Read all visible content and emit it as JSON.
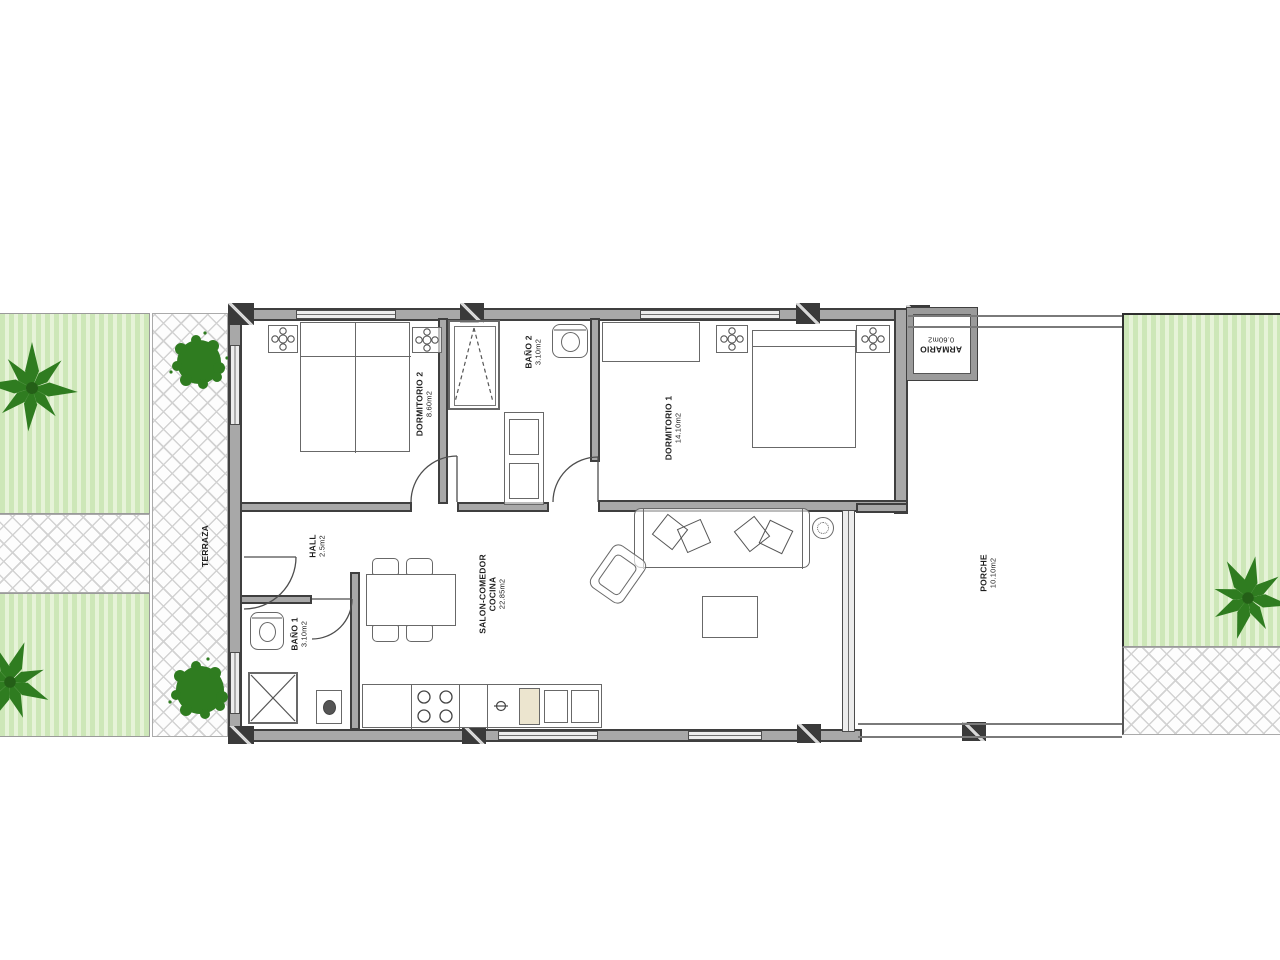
{
  "plan": {
    "type": "apartment floor plan",
    "rooms": {
      "dormitorio2": {
        "name": "DORMITORIO 2",
        "area": "8.60m2"
      },
      "bano2": {
        "name": "BAÑO 2",
        "area": "3.10m2"
      },
      "dormitorio1": {
        "name": "DORMITORIO 1",
        "area": "14.10m2"
      },
      "armario": {
        "name": "ARMARIO",
        "area": "0.60m2"
      },
      "hall": {
        "name": "HALL",
        "area": "2.5m2"
      },
      "salon": {
        "name": "SALON-COMEDOR",
        "name2": "COCINA",
        "area": "22.85m2"
      },
      "bano1": {
        "name": "BAÑO 1",
        "area": "3.10m2"
      },
      "porche": {
        "name": "PORCHE",
        "area": "10.10m2"
      },
      "terraza": {
        "name": "TERRAZA"
      }
    },
    "colors": {
      "lawn": "#cde7b8",
      "lawn_stripe": "#e6f3d8",
      "tree": "#2f7c20",
      "tree_light": "#4f9c38",
      "wall_fill": "#a8a8a8",
      "wall_edge": "#3f3f3f",
      "hatch_line": "#d2d2d2",
      "background": "#ffffff"
    }
  }
}
